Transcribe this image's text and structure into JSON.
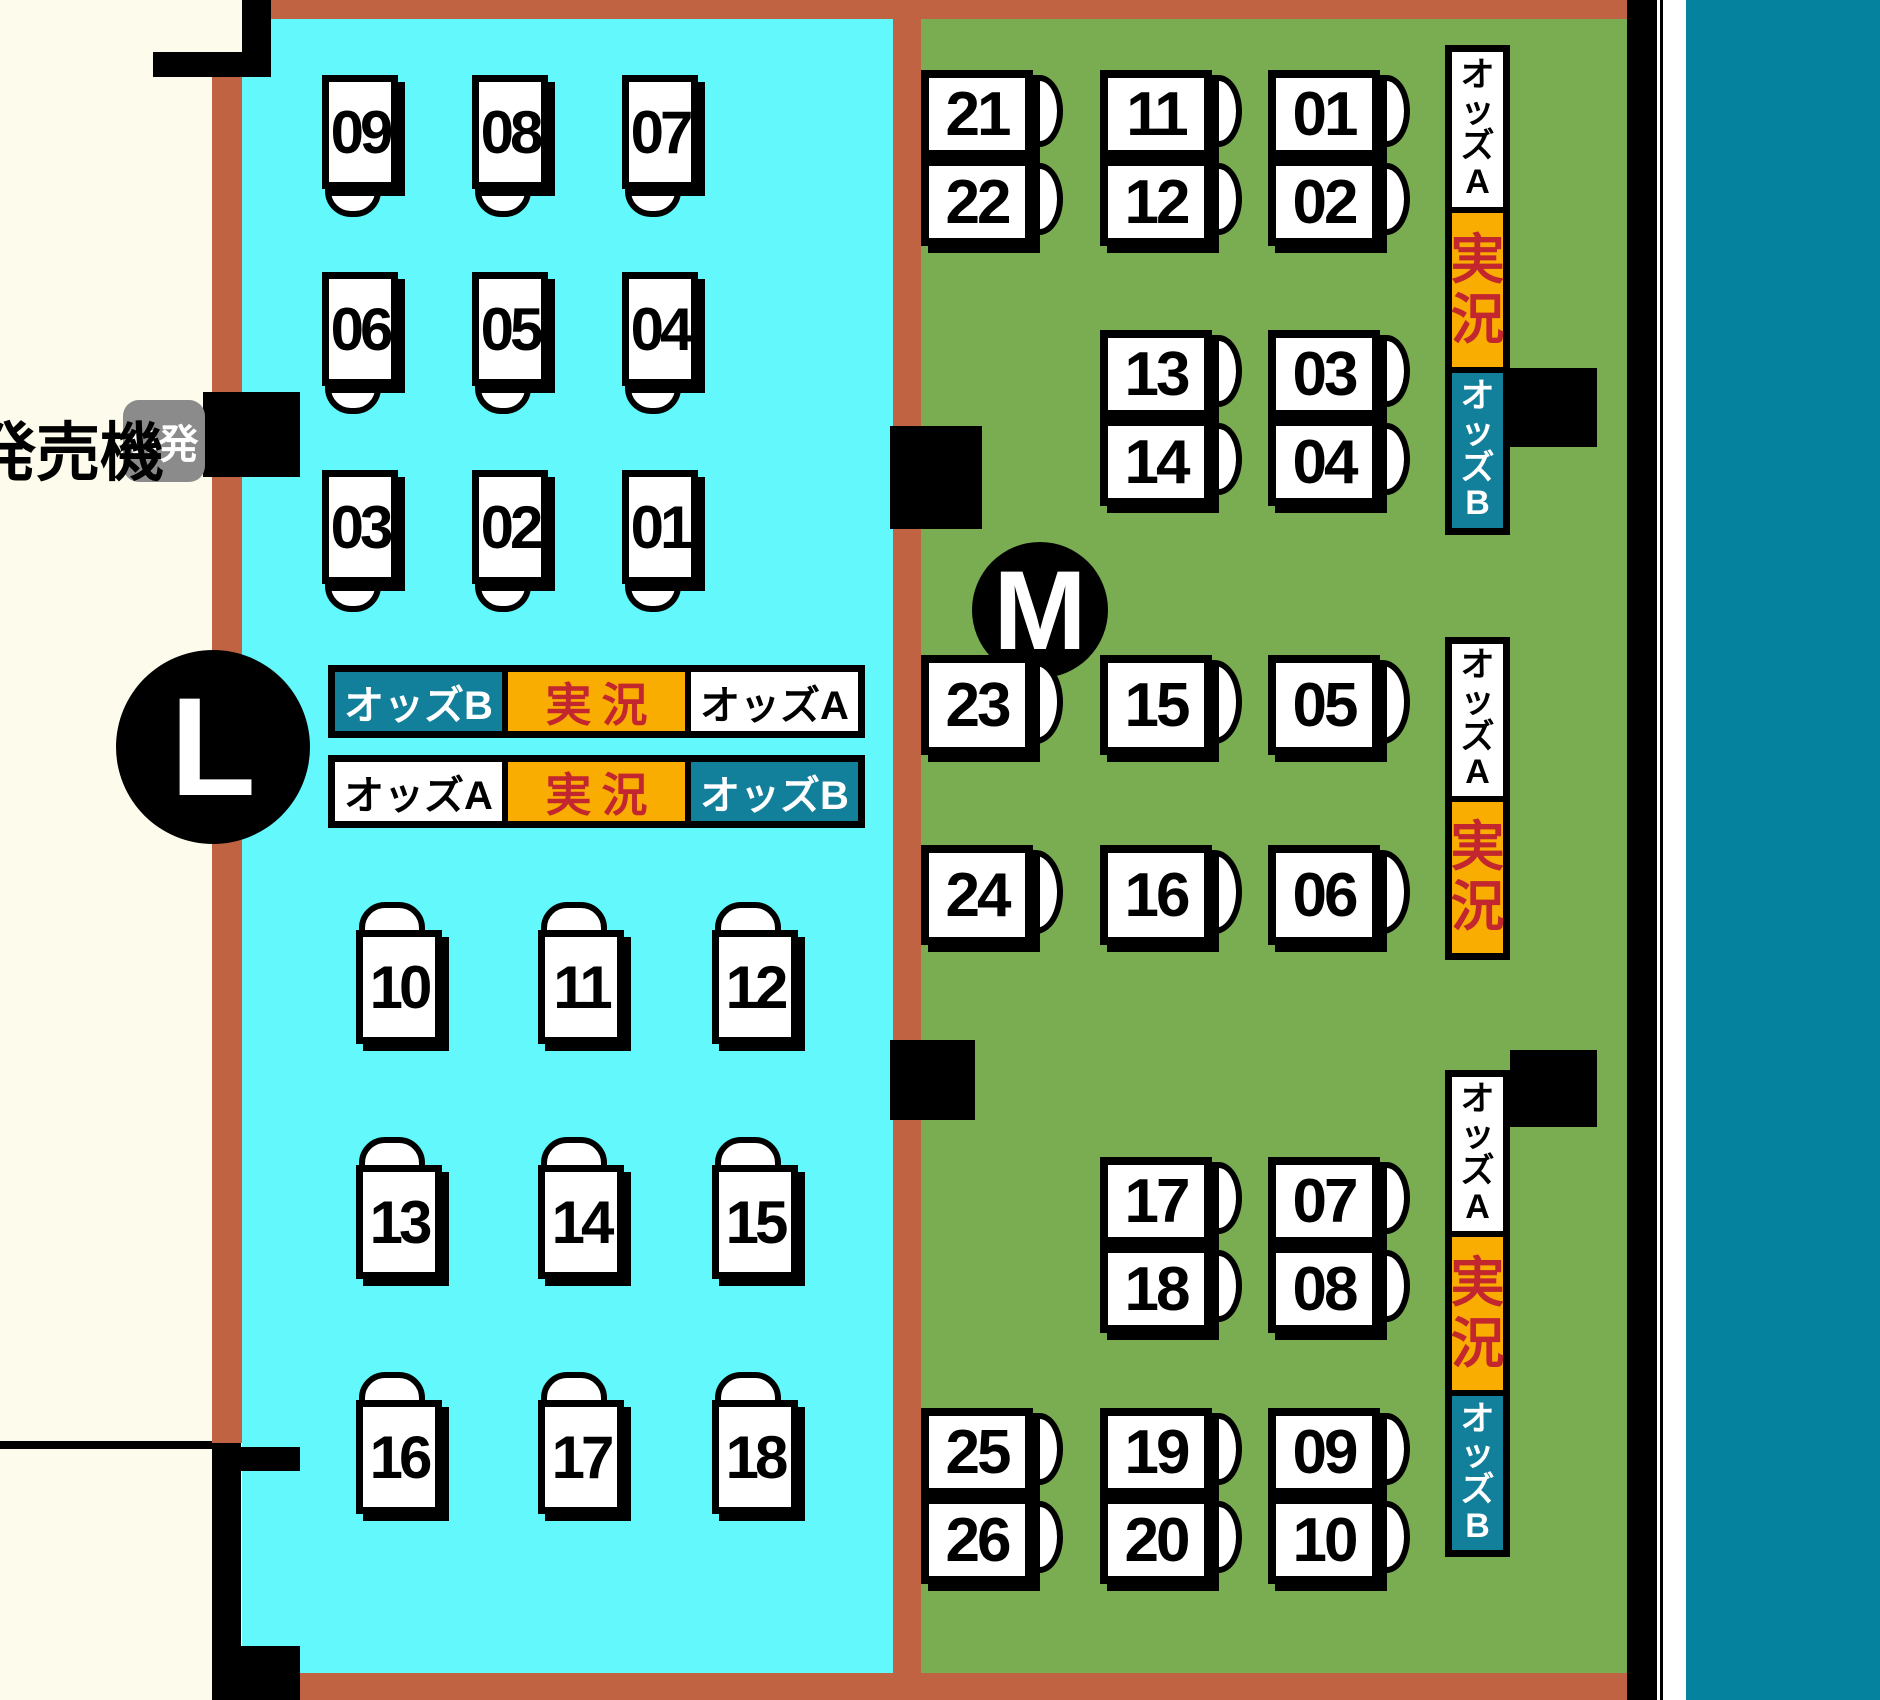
{
  "map": {
    "zone_left_id": "L",
    "zone_right_id": "M",
    "machine_label": "発売機",
    "machine_badge": "U発",
    "labels": {
      "odds_a": "オッズA",
      "odds_b": "オッズB",
      "live": "実況"
    },
    "colors": {
      "background": "#FDFCEC",
      "zone_left_cyan": "#62F8FC",
      "zone_right_green": "#7AAC52",
      "border_brown": "#BF6343",
      "sign_teal": "#12809B",
      "sign_orange": "#F9AD00",
      "live_text_red": "#C2262E",
      "badge_gray": "#8B8B8B",
      "water_teal": "#04829E"
    },
    "cyan_monitor_rows_down": [
      [
        "09",
        "08",
        "07"
      ],
      [
        "06",
        "05",
        "04"
      ],
      [
        "03",
        "02",
        "01"
      ]
    ],
    "cyan_monitor_rows_up": [
      [
        "10",
        "11",
        "12"
      ],
      [
        "13",
        "14",
        "15"
      ],
      [
        "16",
        "17",
        "18"
      ]
    ],
    "horizontal_signs": [
      {
        "segments": [
          "odds_b",
          "live",
          "odds_a"
        ]
      },
      {
        "segments": [
          "odds_a",
          "live",
          "odds_b"
        ]
      }
    ],
    "vertical_signs": [
      {
        "segments": [
          "odds_a",
          "live",
          "odds_b"
        ]
      },
      {
        "segments": [
          "odds_a",
          "live"
        ]
      },
      {
        "segments": [
          "odds_a",
          "live",
          "odds_b"
        ]
      }
    ],
    "green_marker_rows": [
      {
        "type": "pair",
        "items": [
          {
            "col": 0,
            "labels": [
              "21",
              "22"
            ]
          },
          {
            "col": 1,
            "labels": [
              "11",
              "12"
            ]
          },
          {
            "col": 2,
            "labels": [
              "01",
              "02"
            ]
          }
        ]
      },
      {
        "type": "pair",
        "items": [
          {
            "col": 1,
            "labels": [
              "13",
              "14"
            ]
          },
          {
            "col": 2,
            "labels": [
              "03",
              "04"
            ]
          }
        ]
      },
      {
        "type": "single",
        "items": [
          {
            "col": 0,
            "labels": [
              "23"
            ]
          },
          {
            "col": 1,
            "labels": [
              "15"
            ]
          },
          {
            "col": 2,
            "labels": [
              "05"
            ]
          }
        ]
      },
      {
        "type": "single",
        "items": [
          {
            "col": 0,
            "labels": [
              "24"
            ]
          },
          {
            "col": 1,
            "labels": [
              "16"
            ]
          },
          {
            "col": 2,
            "labels": [
              "06"
            ]
          }
        ]
      },
      {
        "type": "pair",
        "items": [
          {
            "col": 1,
            "labels": [
              "17",
              "18"
            ]
          },
          {
            "col": 2,
            "labels": [
              "07",
              "08"
            ]
          }
        ]
      },
      {
        "type": "pair",
        "items": [
          {
            "col": 0,
            "labels": [
              "25",
              "26"
            ]
          },
          {
            "col": 1,
            "labels": [
              "19",
              "20"
            ]
          },
          {
            "col": 2,
            "labels": [
              "09",
              "10"
            ]
          }
        ]
      }
    ]
  }
}
